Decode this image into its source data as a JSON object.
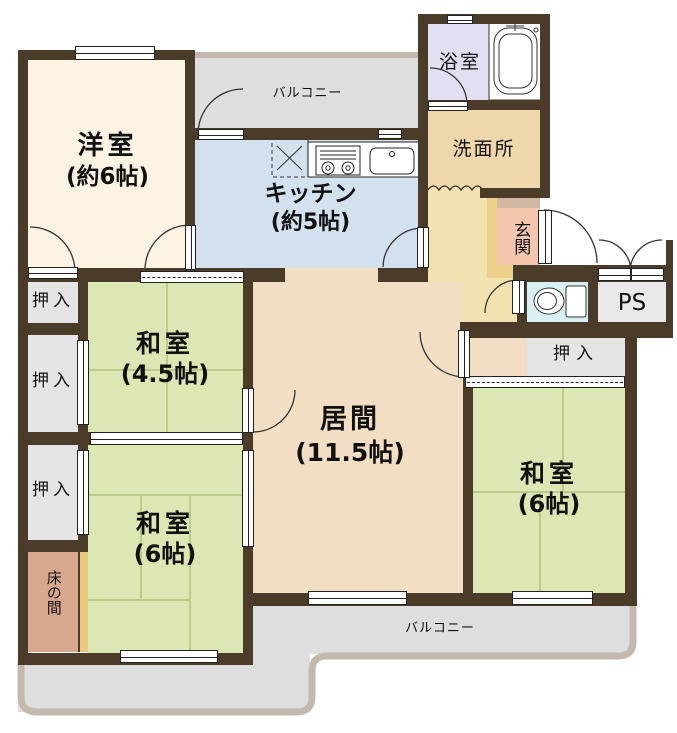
{
  "plan_type": "floor-plan",
  "palette": {
    "wall": "#4b3b29",
    "tatami_green": "#dce8b4",
    "living_tan": "#f2dec2",
    "western_cream": "#fcf3e2",
    "kitchen_blue": "#d3e0ee",
    "bath_lavender": "#e0e0f2",
    "washroom_tan": "#eed7ab",
    "hall_yellow": "#f1e2b0",
    "entrance_pink": "#f3c6ad",
    "entrance_step": "#d0b8a2",
    "entrance_frame": "#edd089",
    "toilet_cyan": "#d9f0f2",
    "closet_gray": "#e5e5e5",
    "tokonoma_brown": "#d7a78e",
    "balcony_gray": "#dedede",
    "balcony_trim": "#c4b9ac"
  },
  "rooms": {
    "western_room": {
      "name": "洋室",
      "size": "(約6帖)"
    },
    "kitchen": {
      "name": "キッチン",
      "size": "(約5帖)"
    },
    "bathroom": {
      "name": "浴室"
    },
    "washroom": {
      "name": "洗面所"
    },
    "entrance": {
      "name": "玄関"
    },
    "pipe_space": {
      "name": "PS"
    },
    "living_room": {
      "name": "居間",
      "size": "(11.5帖)"
    },
    "japanese_room_4_5": {
      "name": "和室",
      "size": "(4.5帖)"
    },
    "japanese_room_6_left": {
      "name": "和室",
      "size": "(6帖)"
    },
    "japanese_room_6_right": {
      "name": "和室",
      "size": "(6帖)"
    },
    "tokonoma": {
      "name": "床の間"
    },
    "balcony_top": {
      "name": "バルコニー"
    },
    "balcony_bottom": {
      "name": "バルコニー"
    },
    "closets": [
      "押入",
      "押入",
      "押入",
      "押入"
    ]
  }
}
